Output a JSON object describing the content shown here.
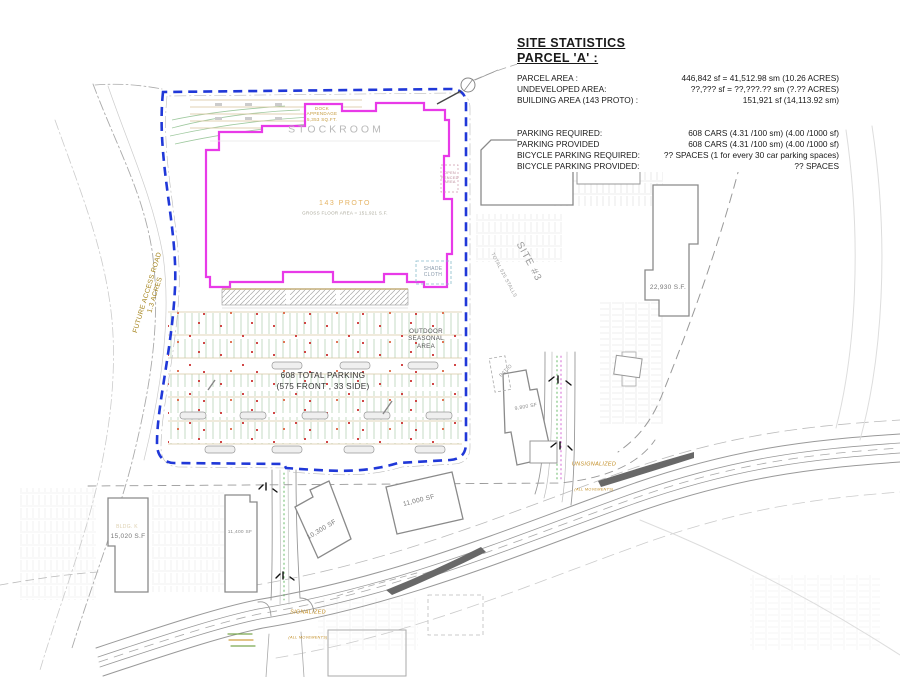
{
  "stats": {
    "heading": "SITE STATISTICS",
    "subheading": "PARCEL 'A' :",
    "rows": [
      {
        "label": "PARCEL AREA :",
        "value": "446,842 sf = 41,512.98 sm  (10.26 ACRES)"
      },
      {
        "label": "UNDEVELOPED AREA:",
        "value": "??,??? sf = ??,???.?? sm (?.?? ACRES)"
      },
      {
        "label": "BUILDING AREA  (143  PROTO) :",
        "value": "151,921 sf (14,113.92 sm)"
      },
      {
        "label": "PARKING REQUIRED:",
        "value": "608 CARS (4.31 /100 sm) (4.00 /1000 sf)"
      },
      {
        "label": "PARKING PROVIDED",
        "value": "608 CARS (4.31 /100 sm) (4.00 /1000 sf)"
      },
      {
        "label": "BICYCLE PARKING REQUIRED:",
        "value": "?? SPACES (1 for every 30 car parking spaces)"
      },
      {
        "label": "BICYCLE PARKING PROVIDED:",
        "value": "?? SPACES"
      }
    ]
  },
  "plan": {
    "labels": {
      "stockroom": "STOCKROOM",
      "dock_appendage": "DOCK\nAPPENDAGE\n5,353 SQ.FT.",
      "proto_name": "143 PROTO",
      "proto_area": "GROSS FLOOR AREA  =  151,921 S.F.",
      "open_fenced": "OPEN\nFENCED\nAREA",
      "shade_cloth": "SHADE\nCLOTH",
      "outdoor_seasonal": "OUTDOOR\nSEASONAL\nAREA",
      "total_parking": "608 TOTAL  PARKING\n(575 FRONT , 33 SIDE)",
      "future_access_road": "FUTURE ACCESS ROAD\n1.3 ACRES",
      "site3": "SITE #3",
      "site3_stalls": "TOTAL 525 STALLS",
      "bldg_d_area": "22,930 S.F.",
      "patio": "PATIO",
      "bldg_9800": "9,800 SF",
      "bldg_k": "BLDG. K",
      "bldg_15020": "15,020 S.F",
      "bldg_11400": "11,400 SF",
      "bldg_10300": "10,300 SF",
      "bldg_11000": "11,000 SF",
      "unsignalized": "UNSIGNALIZED",
      "unsignalized_note": "(ALL MOVEMENTS)",
      "signalized": "SIGNALIZED",
      "signalized_note": "(ALL MOVEMENTS)"
    }
  },
  "colors": {
    "parcel_boundary_blue": "#2038d8",
    "building_outline_magenta": "#e83ae8",
    "cad_orange": "#c08a1e",
    "stall_green": "#b5d2b5",
    "marker_red": "#cc3333",
    "drawing_gray": "#999999"
  }
}
